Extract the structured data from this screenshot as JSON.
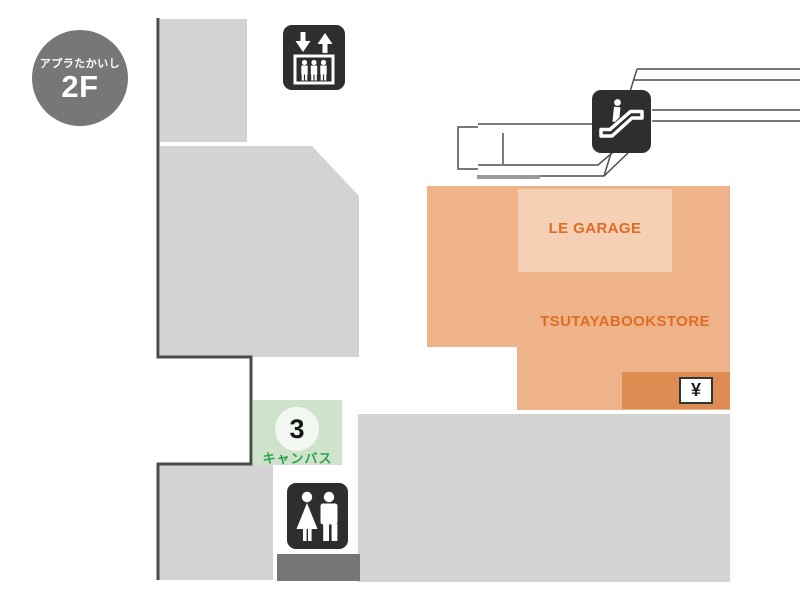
{
  "floor_map": {
    "badge": {
      "building_name": "アプラたかいし",
      "floor_label": "2F"
    },
    "areas": {
      "tsutaya": {
        "name": "TSUTAYABOOKSTORE",
        "fill": "#efb38a",
        "text_color": "#e06c24"
      },
      "le_garage": {
        "name": "LE GARAGE",
        "fill": "#f5d0b4",
        "text_color": "#e06c24"
      },
      "canvas": {
        "number": "3",
        "name": "キャンバス",
        "fill": "#cfe3cc",
        "text_color": "#2ca14a"
      },
      "atm": {
        "symbol": "¥",
        "fill": "#de8d52"
      }
    },
    "icons": [
      {
        "name": "elevator-icon"
      },
      {
        "name": "escalator-icon"
      },
      {
        "name": "restroom-icon"
      },
      {
        "name": "yen-atm-icon"
      }
    ],
    "colors": {
      "walkway_white": "#ffffff",
      "shop_gray": "#d3d3d3",
      "dark_gray_strip": "#767676",
      "badge_gray": "#77777a",
      "wall_line": "#4a4a4a",
      "guide_line": "#4f4f4f",
      "icon_black": "#2e2e31"
    }
  }
}
